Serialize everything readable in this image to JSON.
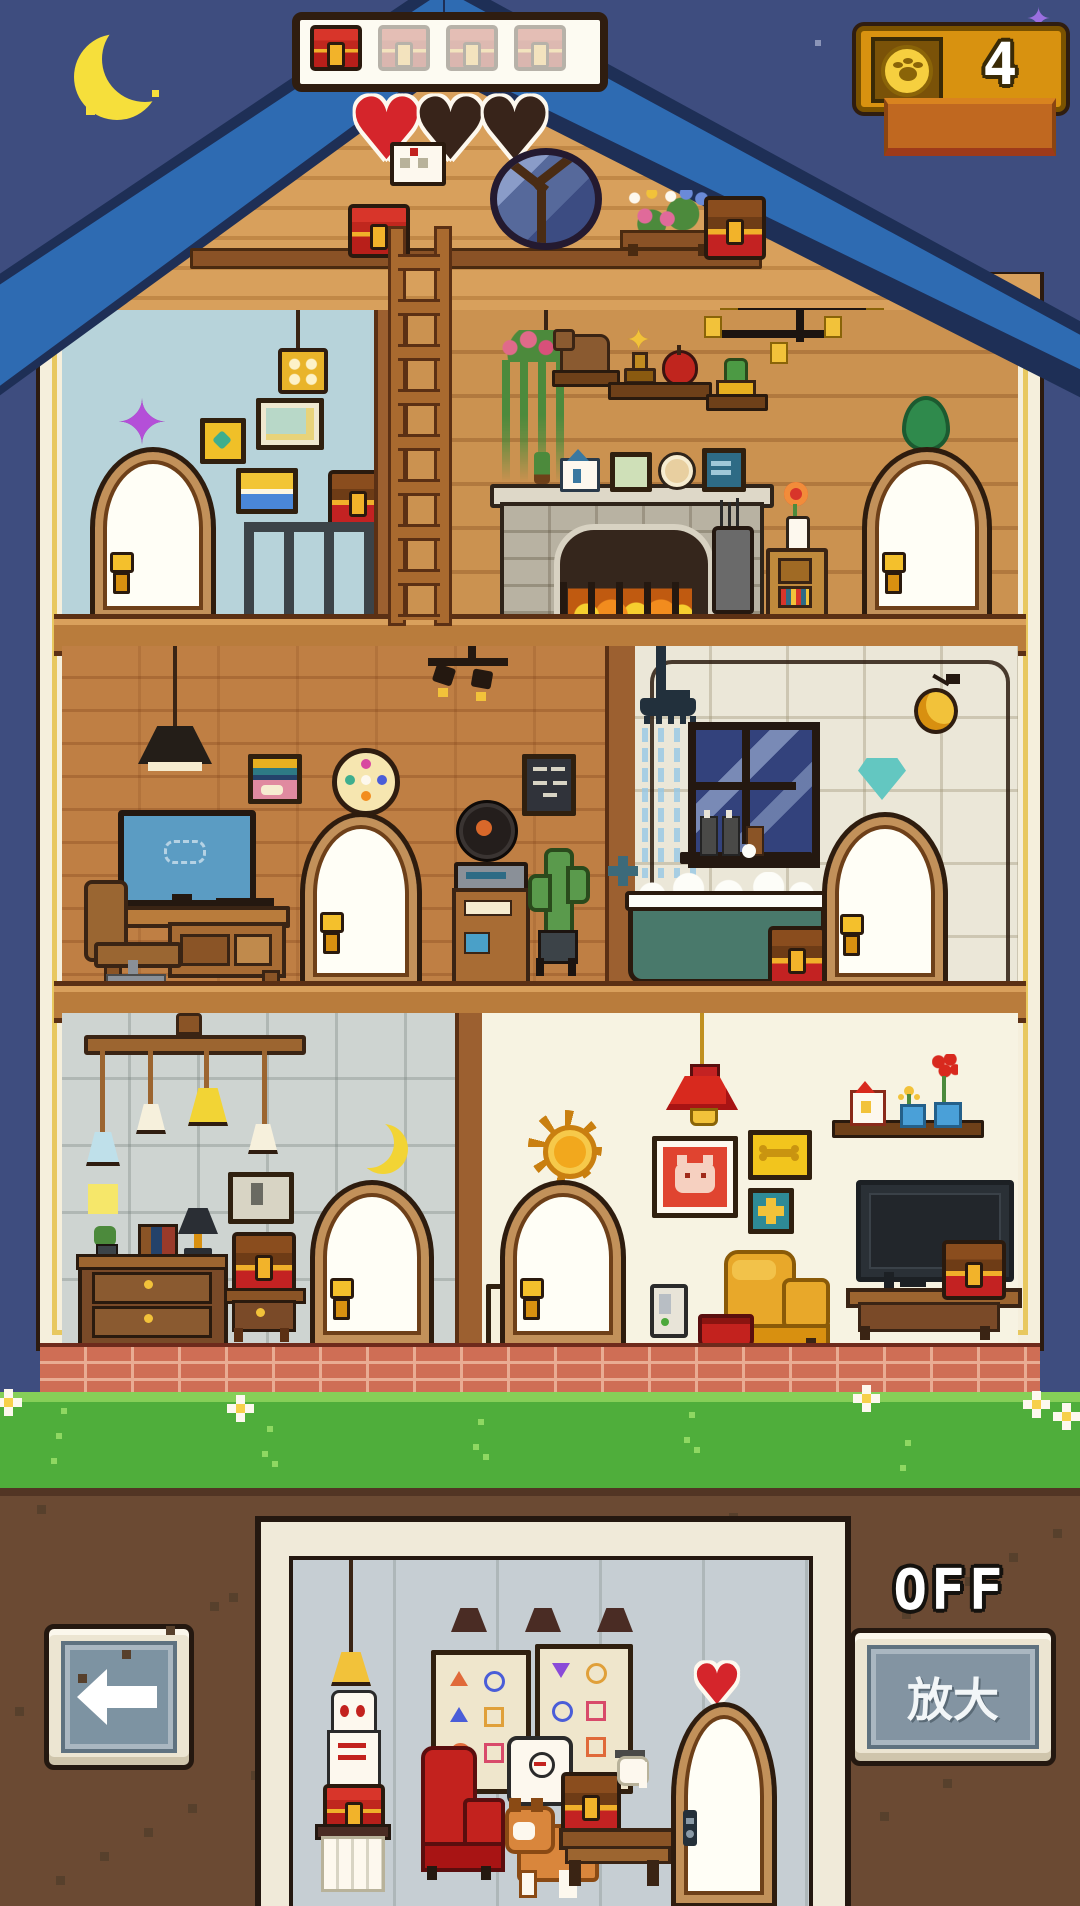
{
  "hud": {
    "chest_bar": {
      "slots": 4,
      "filled": 1
    },
    "coin_counter": {
      "value": "4",
      "icon": "paw-coin-icon"
    },
    "hearts": {
      "total": 3,
      "filled": 1
    }
  },
  "footer": {
    "power_status_label": "OFF",
    "zoom_button_label": "放大"
  },
  "icons": [
    "moon-icon",
    "sparkle-icon",
    "treasure-chest-icon",
    "paw-coin-icon",
    "heart-icon",
    "envelope-icon",
    "back-arrow-icon",
    "sun-decal",
    "moon-decal",
    "diamond-decal",
    "leaf-decal"
  ],
  "palette": {
    "sky": "#3e4d7f",
    "roof_blue": "#2e6bb2",
    "roof_outline": "#1e2f56",
    "gable_wood": "#d8a05c",
    "frame_cream": "#f5efdc",
    "beam_wood": "#b97c3c",
    "room_blue": "#b7d3da",
    "room_plank": "#cb9250",
    "room_brick": "#bf7f44",
    "room_tile": "#ebe7d8",
    "room_gray": "#ced4d1",
    "room_cream": "#f7f3e2",
    "accent_gold": "#f2b32a",
    "chest_red": "#cf2e24",
    "grass": "#4fae3b",
    "dirt": "#6b4a33",
    "button_slate": "#8394a2",
    "coin_panel": "#d89210"
  }
}
